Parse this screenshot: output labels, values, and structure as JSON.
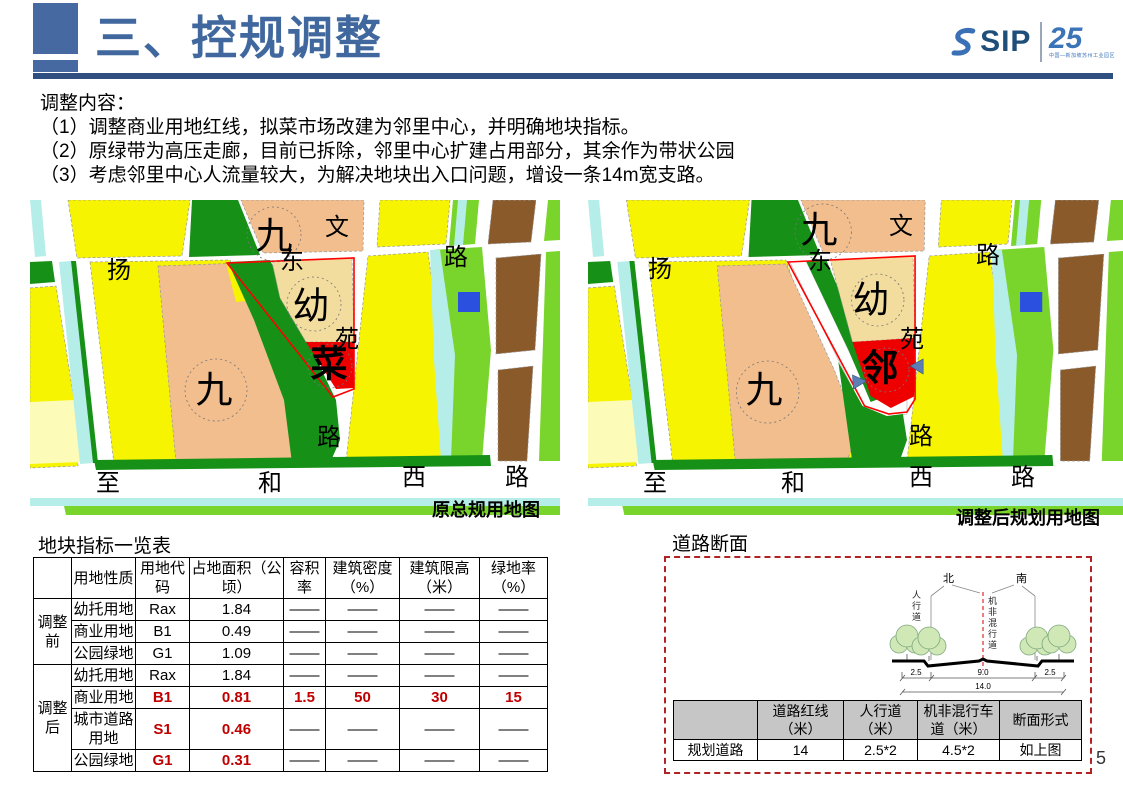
{
  "header": {
    "title": "三、控规调整",
    "logo": {
      "sip": "SIP",
      "anniversary": "25",
      "tagline": "中国—新加坡苏州工业园区"
    }
  },
  "content": {
    "intro": "调整内容：",
    "items": [
      "（1）调整商业用地红线，拟菜市场改建为邻里中心，并明确地块指标。",
      "（2）原绿带为高压走廊，目前已拆除，邻里中心扩建占用部分，其余作为带状公园",
      "（3）考虑邻里中心人流量较大，为解决地块出入口问题，增设一条14m宽支路。"
    ]
  },
  "maps": {
    "left": {
      "caption": "原总规用地图",
      "labels": [
        {
          "t": "九",
          "x": 244,
          "y": 36,
          "big": 1
        },
        {
          "t": "扬",
          "x": 89,
          "y": 71
        },
        {
          "t": "东",
          "x": 262,
          "y": 62
        },
        {
          "t": "文",
          "x": 307,
          "y": 28
        },
        {
          "t": "路",
          "x": 426,
          "y": 58
        },
        {
          "t": "幼",
          "x": 281,
          "y": 106,
          "big": 1
        },
        {
          "t": "苑",
          "x": 317,
          "y": 140
        },
        {
          "t": "菜",
          "x": 299,
          "y": 164,
          "big": 1,
          "heavy": 1
        },
        {
          "t": "九",
          "x": 184,
          "y": 190,
          "big": 1
        },
        {
          "t": "路",
          "x": 299,
          "y": 238
        },
        {
          "t": "至",
          "x": 78,
          "y": 284
        },
        {
          "t": "和",
          "x": 240,
          "y": 284
        },
        {
          "t": "西",
          "x": 384,
          "y": 278
        },
        {
          "t": "路",
          "x": 487,
          "y": 278
        }
      ]
    },
    "right": {
      "caption": "调整后规划用地图",
      "labels": [
        {
          "t": "九",
          "x": 231,
          "y": 30,
          "big": 1
        },
        {
          "t": "扬",
          "x": 72,
          "y": 70
        },
        {
          "t": "东",
          "x": 232,
          "y": 62
        },
        {
          "t": "文",
          "x": 313,
          "y": 27
        },
        {
          "t": "路",
          "x": 400,
          "y": 56
        },
        {
          "t": "幼",
          "x": 283,
          "y": 100,
          "big": 1
        },
        {
          "t": "苑",
          "x": 324,
          "y": 140
        },
        {
          "t": "邻",
          "x": 292,
          "y": 168,
          "big": 1,
          "heavy": 1
        },
        {
          "t": "九",
          "x": 176,
          "y": 190,
          "big": 1
        },
        {
          "t": "路",
          "x": 333,
          "y": 237
        },
        {
          "t": "至",
          "x": 67,
          "y": 284
        },
        {
          "t": "和",
          "x": 205,
          "y": 284
        },
        {
          "t": "西",
          "x": 333,
          "y": 278
        },
        {
          "t": "路",
          "x": 435,
          "y": 278
        }
      ]
    }
  },
  "plot_table": {
    "title": "地块指标一览表",
    "headers": [
      "",
      "用地性质",
      "用地代码",
      "占地面积（公顷）",
      "容积率",
      "建筑密度（%）",
      "建筑限高（米）",
      "绿地率（%）"
    ],
    "groups": [
      "调整前",
      "调整后"
    ],
    "rows": [
      {
        "cells": [
          "幼托用地",
          "Rax",
          "1.84",
          "——",
          "——",
          "——",
          "——"
        ]
      },
      {
        "cells": [
          "商业用地",
          "B1",
          "0.49",
          "——",
          "——",
          "——",
          "——"
        ]
      },
      {
        "cells": [
          "公园绿地",
          "G1",
          "1.09",
          "——",
          "——",
          "——",
          "——"
        ]
      },
      {
        "cells": [
          "幼托用地",
          "Rax",
          "1.84",
          "——",
          "——",
          "——",
          "——"
        ]
      },
      {
        "cells": [
          "商业用地",
          "B1",
          "0.81",
          "1.5",
          "50",
          "30",
          "15"
        ]
      },
      {
        "cells": [
          "城市道路用地",
          "S1",
          "0.46",
          "——",
          "——",
          "——",
          "——"
        ]
      },
      {
        "cells": [
          "公园绿地",
          "G1",
          "0.31",
          "——",
          "——",
          "——",
          "——"
        ]
      }
    ]
  },
  "road_section": {
    "title": "道路断面",
    "diagram": {
      "north": "北",
      "south": "南",
      "sidewalk_label": "人行道",
      "mixed_label": "机非混行道",
      "dim_left": "2.5",
      "dim_mid": "9.0",
      "dim_right": "2.5",
      "dim_total": "14.0"
    },
    "table": {
      "headers": [
        "",
        "道路红线（米）",
        "人行道（米）",
        "机非混行车道（米）",
        "断面形式"
      ],
      "row_label": "规划道路",
      "values": [
        "14",
        "2.5*2",
        "4.5*2",
        "如上图"
      ]
    }
  },
  "page_number": "5",
  "colors": {
    "accent_blue": "#40689E",
    "rule_blue": "#2E4F80",
    "parcel_yellow": "#F6F400",
    "parcel_peach": "#F2BE8E",
    "parcel_cream": "#F2DC9E",
    "green_dark": "#169016",
    "green_bright": "#79D52B",
    "water_cyan": "#B5EEE8",
    "parcel_brown": "#8B5A2B",
    "parcel_red": "#EE0000",
    "outline_red": "#FF0000",
    "table_red": "#C00000",
    "box_red": "#B22222",
    "utility_blue": "#2B50E0"
  }
}
